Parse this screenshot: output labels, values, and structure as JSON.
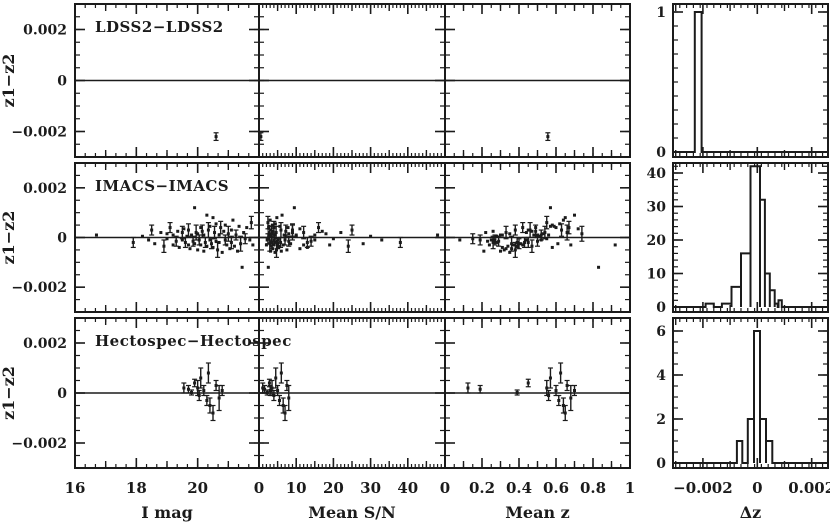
{
  "figure": {
    "bg": "#ffffff",
    "ink": "#1b1b1b",
    "rows": [
      {
        "title": "LDSS2−LDSS2"
      },
      {
        "title": "IMACS−IMACS"
      },
      {
        "title": "Hectospec−Hectospec"
      }
    ],
    "y_axis_label": "z1−z2",
    "x_axis_labels": [
      "I mag",
      "Mean S/N",
      "Mean z"
    ],
    "hist_x_label": "Δz"
  },
  "chart_data": [
    {
      "type": "scatter",
      "grid_row": 0,
      "title": "LDSS2−LDSS2",
      "x_vars": [
        "imag",
        "mean_sn",
        "mean_z"
      ],
      "ylabel": "z1−z2",
      "ylim": [
        -0.003,
        0.003
      ],
      "point_format": [
        "imag",
        "mean_sn",
        "mean_z",
        "dz",
        "err"
      ],
      "points": [
        [
          20.6,
          0.5,
          0.556,
          -0.0022,
          0.00015
        ]
      ]
    },
    {
      "type": "scatter",
      "grid_row": 1,
      "title": "IMACS−IMACS",
      "x_vars": [
        "imag",
        "mean_sn",
        "mean_z"
      ],
      "ylabel": "z1−z2",
      "ylim": [
        -0.003,
        0.003
      ],
      "point_format": [
        "imag",
        "mean_sn",
        "mean_z",
        "dz",
        "err"
      ],
      "points": [
        [
          16.7,
          48,
          0.31,
          0.0001,
          0
        ],
        [
          17.9,
          38,
          0.45,
          -0.0002,
          0.0002
        ],
        [
          18.2,
          30,
          0.28,
          5e-05,
          0
        ],
        [
          18.4,
          33,
          0.52,
          -0.0001,
          0
        ],
        [
          18.5,
          25,
          0.38,
          0.0003,
          0.0002
        ],
        [
          18.6,
          28,
          0.61,
          -0.00025,
          0
        ],
        [
          18.8,
          22,
          0.22,
          0.0002,
          0
        ],
        [
          18.9,
          24,
          0.47,
          -0.00035,
          0.00025
        ],
        [
          19.0,
          18,
          0.35,
          0.00015,
          0
        ],
        [
          19.0,
          20,
          0.55,
          -5e-05,
          0
        ],
        [
          19.1,
          16,
          0.42,
          0.0004,
          0.0002
        ],
        [
          19.2,
          19,
          0.68,
          -0.0003,
          0
        ],
        [
          19.2,
          15,
          0.3,
          0.0001,
          0
        ],
        [
          19.3,
          14,
          0.5,
          -0.00015,
          0.0002
        ],
        [
          19.35,
          17,
          0.26,
          0.00025,
          0
        ],
        [
          19.4,
          13,
          0.58,
          -0.0004,
          0
        ],
        [
          19.5,
          12,
          0.33,
          0.0002,
          0.00025
        ],
        [
          19.5,
          15,
          0.44,
          -0.0001,
          0
        ],
        [
          19.55,
          11,
          0.72,
          0.00035,
          0
        ],
        [
          19.6,
          13,
          0.39,
          -0.0002,
          0.0002
        ],
        [
          19.65,
          10,
          0.51,
          5e-05,
          0
        ],
        [
          19.7,
          12,
          0.24,
          -0.0003,
          0
        ],
        [
          19.7,
          9,
          0.63,
          0.0003,
          0.00025
        ],
        [
          19.75,
          11,
          0.36,
          -0.00045,
          0
        ],
        [
          19.8,
          10,
          0.48,
          0.0001,
          0
        ],
        [
          19.85,
          8,
          0.29,
          -0.00015,
          0.0002
        ],
        [
          19.9,
          9.5,
          0.57,
          0.0012,
          0
        ],
        [
          19.9,
          8.5,
          0.41,
          -0.00025,
          0
        ],
        [
          19.95,
          9,
          0.66,
          0.0002,
          0.0003
        ],
        [
          20.0,
          7.5,
          0.32,
          -0.0005,
          0
        ],
        [
          20.0,
          8,
          0.53,
          0.00015,
          0
        ],
        [
          20.05,
          7,
          0.27,
          -0.0001,
          0.0002
        ],
        [
          20.1,
          7.8,
          0.6,
          0.0004,
          0
        ],
        [
          20.1,
          6.5,
          0.37,
          -0.0003,
          0
        ],
        [
          20.15,
          7.2,
          0.49,
          0.00025,
          0.00025
        ],
        [
          20.2,
          6,
          0.21,
          -0.00055,
          0
        ],
        [
          20.2,
          6.8,
          0.56,
          0.0001,
          0
        ],
        [
          20.25,
          5.8,
          0.43,
          -0.0002,
          0.0002
        ],
        [
          20.3,
          6.2,
          0.7,
          0.0009,
          0
        ],
        [
          20.3,
          5.5,
          0.34,
          -0.00035,
          0
        ],
        [
          20.35,
          5.9,
          0.46,
          0.0003,
          0.0003
        ],
        [
          20.4,
          5.2,
          0.25,
          -0.0001,
          0
        ],
        [
          20.4,
          5.6,
          0.59,
          0.00045,
          0
        ],
        [
          20.45,
          5,
          0.4,
          -0.00025,
          0.0002
        ],
        [
          20.5,
          4.8,
          0.65,
          0.0008,
          0
        ],
        [
          20.5,
          5.3,
          0.31,
          -0.0004,
          0
        ],
        [
          20.55,
          4.6,
          0.54,
          0.0002,
          0.00025
        ],
        [
          20.6,
          4.9,
          0.23,
          -0.00015,
          0
        ],
        [
          20.6,
          4.4,
          0.62,
          0.00055,
          0
        ],
        [
          20.65,
          4.7,
          0.38,
          -0.0005,
          0.0003
        ],
        [
          20.7,
          4.2,
          0.5,
          0.0001,
          0
        ],
        [
          20.7,
          4.5,
          0.28,
          -0.0002,
          0
        ],
        [
          20.75,
          4,
          0.67,
          0.0004,
          0.00025
        ],
        [
          20.8,
          4.3,
          0.35,
          -0.0006,
          0
        ],
        [
          20.85,
          3.8,
          0.47,
          0.00025,
          0
        ],
        [
          20.9,
          4.1,
          0.19,
          -0.0001,
          0.0002
        ],
        [
          20.9,
          3.6,
          0.58,
          0.0005,
          0
        ],
        [
          20.95,
          3.9,
          0.42,
          -0.0003,
          0
        ],
        [
          21.0,
          3.4,
          0.74,
          0.00015,
          0.0003
        ],
        [
          21.05,
          3.7,
          0.33,
          -0.00045,
          0
        ],
        [
          21.1,
          3.2,
          0.45,
          0.0003,
          0
        ],
        [
          21.1,
          3.5,
          0.26,
          -0.0002,
          0.00025
        ],
        [
          21.15,
          3,
          0.64,
          0.0007,
          0
        ],
        [
          21.2,
          3.3,
          0.39,
          -0.00035,
          0
        ],
        [
          21.25,
          2.9,
          0.52,
          0.0001,
          0.0002
        ],
        [
          21.3,
          3.1,
          0.3,
          -0.00055,
          0
        ],
        [
          21.35,
          2.7,
          0.57,
          0.00045,
          0
        ],
        [
          21.4,
          2.9,
          0.36,
          -0.00025,
          0.0003
        ],
        [
          21.45,
          2.5,
          0.83,
          -0.0012,
          0
        ],
        [
          21.5,
          2.7,
          0.44,
          0.0002,
          0
        ],
        [
          21.55,
          2.4,
          0.15,
          -5e-05,
          0.0002
        ],
        [
          21.6,
          2.6,
          0.49,
          0.0004,
          0
        ],
        [
          21.7,
          2.2,
          0.08,
          -0.0001,
          0
        ],
        [
          21.75,
          2.4,
          0.55,
          0.0006,
          0.00025
        ],
        [
          21.8,
          2,
          0.92,
          -0.0003,
          0
        ]
      ]
    },
    {
      "type": "scatter",
      "grid_row": 2,
      "title": "Hectospec−Hectospec",
      "x_vars": [
        "imag",
        "mean_sn",
        "mean_z"
      ],
      "ylabel": "z1−z2",
      "ylim": [
        -0.003,
        0.003
      ],
      "point_format": [
        "imag",
        "mean_sn",
        "mean_z",
        "dz",
        "err"
      ],
      "points": [
        [
          19.55,
          1.0,
          0.124,
          0.0002,
          0.0002
        ],
        [
          19.7,
          1.5,
          0.19,
          0.00015,
          0.00015
        ],
        [
          19.8,
          2.2,
          0.39,
          2e-05,
          0.0001
        ],
        [
          19.9,
          2.8,
          0.45,
          0.0004,
          0.00015
        ],
        [
          20.0,
          3.5,
          0.55,
          0.0002,
          0.0003
        ],
        [
          20.05,
          4.0,
          0.56,
          -0.0001,
          0.0002
        ],
        [
          20.1,
          4.5,
          0.57,
          0.0006,
          0.0004
        ],
        [
          20.2,
          5.0,
          0.6,
          0.0001,
          0.0002
        ],
        [
          20.3,
          5.5,
          0.615,
          -0.0003,
          0.0002
        ],
        [
          20.35,
          6.0,
          0.625,
          0.0008,
          0.0004
        ],
        [
          20.4,
          6.5,
          0.64,
          -0.0005,
          0.0003
        ],
        [
          20.5,
          7.0,
          0.65,
          -0.0008,
          0.0003
        ],
        [
          20.6,
          7.5,
          0.66,
          0.0003,
          0.0002
        ],
        [
          20.7,
          8.0,
          0.68,
          -0.0002,
          0.0005
        ],
        [
          20.8,
          3.0,
          0.7,
          0.0001,
          0.0002
        ]
      ]
    },
    {
      "type": "histogram",
      "grid_row": 0,
      "xlabel": "Δz",
      "ylim": [
        0,
        1
      ],
      "bin_format": [
        "dz_min",
        "dz_max",
        "count"
      ],
      "bins": [
        [
          -0.0023,
          -0.00205,
          1
        ]
      ]
    },
    {
      "type": "histogram",
      "grid_row": 1,
      "xlabel": "Δz",
      "ylim": [
        0,
        42
      ],
      "bin_format": [
        "dz_min",
        "dz_max",
        "count"
      ],
      "bins": [
        [
          -0.0019,
          -0.0016,
          1
        ],
        [
          -0.0013,
          -0.00095,
          1
        ],
        [
          -0.00095,
          -0.0006,
          6
        ],
        [
          -0.0006,
          -0.00025,
          16
        ],
        [
          -0.00025,
          0.0001,
          42
        ],
        [
          0.0001,
          0.00028,
          32
        ],
        [
          0.00028,
          0.00046,
          10
        ],
        [
          0.00046,
          0.00064,
          5
        ],
        [
          0.00064,
          0.00075,
          1
        ],
        [
          0.00078,
          0.0009,
          2
        ]
      ]
    },
    {
      "type": "histogram",
      "grid_row": 2,
      "xlabel": "Δz",
      "ylim": [
        0,
        6
      ],
      "bin_format": [
        "dz_min",
        "dz_max",
        "count"
      ],
      "bins": [
        [
          -0.00075,
          -0.00055,
          1
        ],
        [
          -0.00035,
          -0.00012,
          2
        ],
        [
          -0.00012,
          0.0001,
          6
        ],
        [
          0.0001,
          0.00032,
          2
        ],
        [
          0.00032,
          0.00055,
          1
        ]
      ]
    }
  ],
  "layout": {
    "width": 830,
    "height": 526,
    "rows": [
      [
        4,
        157
      ],
      [
        163,
        312
      ],
      [
        318,
        468
      ]
    ],
    "cols": [
      {
        "x": [
          75,
          259
        ],
        "xlim": [
          16,
          22
        ],
        "majors": [
          16,
          18,
          20,
          22
        ],
        "mediums": [
          17,
          19,
          21
        ],
        "minor_step": 0.3333,
        "tick_labels": [
          [
            16,
            "16"
          ],
          [
            18,
            "18"
          ],
          [
            20,
            "20"
          ]
        ],
        "label": "I mag"
      },
      {
        "x": [
          259,
          445
        ],
        "xlim": [
          0,
          50
        ],
        "majors": [
          0,
          10,
          20,
          30,
          40,
          50
        ],
        "mediums": [
          5,
          15,
          25,
          35,
          45
        ],
        "minor_step": 1,
        "tick_labels": [
          [
            0,
            "0"
          ],
          [
            10,
            "10"
          ],
          [
            20,
            "20"
          ],
          [
            30,
            "30"
          ],
          [
            40,
            "40"
          ]
        ],
        "label": "Mean S/N"
      },
      {
        "x": [
          445,
          630
        ],
        "xlim": [
          0,
          1
        ],
        "majors": [
          0,
          0.2,
          0.4,
          0.6,
          0.8,
          1
        ],
        "mediums": [
          0.1,
          0.3,
          0.5,
          0.7,
          0.9
        ],
        "minor_step": 0.05,
        "tick_labels": [
          [
            0,
            "0"
          ],
          [
            0.2,
            "0.2"
          ],
          [
            0.4,
            "0.4"
          ],
          [
            0.6,
            "0.6"
          ],
          [
            0.8,
            "0.8"
          ],
          [
            1,
            "1"
          ]
        ],
        "label": "Mean z"
      }
    ],
    "scatter_y": {
      "lim": [
        -0.003,
        0.003
      ],
      "majors": [
        -0.002,
        0,
        0.002
      ],
      "minor_step": 0.0005,
      "tick_labels": [
        [
          0.002,
          "0.002"
        ],
        [
          0,
          "0"
        ],
        [
          -0.002,
          "−0.002"
        ]
      ],
      "label": "z1−z2"
    },
    "hist": {
      "x": [
        673,
        828
      ],
      "xlim": [
        -0.0031,
        0.0026
      ],
      "majors": [
        -0.002,
        0,
        0.002
      ],
      "mediums": [
        -0.003,
        -0.001,
        0.001
      ],
      "minor_step": 0.00025,
      "tick_labels": [
        [
          -0.002,
          "−0.002"
        ],
        [
          0,
          "0"
        ],
        [
          0.002,
          "0.002"
        ]
      ],
      "label": "Δz",
      "y": [
        {
          "ppu": 140,
          "majors": [
            0,
            1
          ],
          "minor_step": 0.1,
          "tick_labels": [
            [
              1,
              "1"
            ],
            [
              0,
              "0"
            ]
          ]
        },
        {
          "ppu": 3.35,
          "majors": [
            0,
            10,
            20,
            30,
            40
          ],
          "minor_step": 2,
          "tick_labels": [
            [
              40,
              "40"
            ],
            [
              30,
              "30"
            ],
            [
              20,
              "20"
            ],
            [
              10,
              "10"
            ],
            [
              0,
              "0"
            ]
          ]
        },
        {
          "ppu": 22,
          "majors": [
            0,
            2,
            4,
            6
          ],
          "minor_step": 0.5,
          "tick_labels": [
            [
              6,
              "6"
            ],
            [
              4,
              "4"
            ],
            [
              2,
              "2"
            ],
            [
              0,
              "0"
            ]
          ]
        }
      ]
    }
  }
}
